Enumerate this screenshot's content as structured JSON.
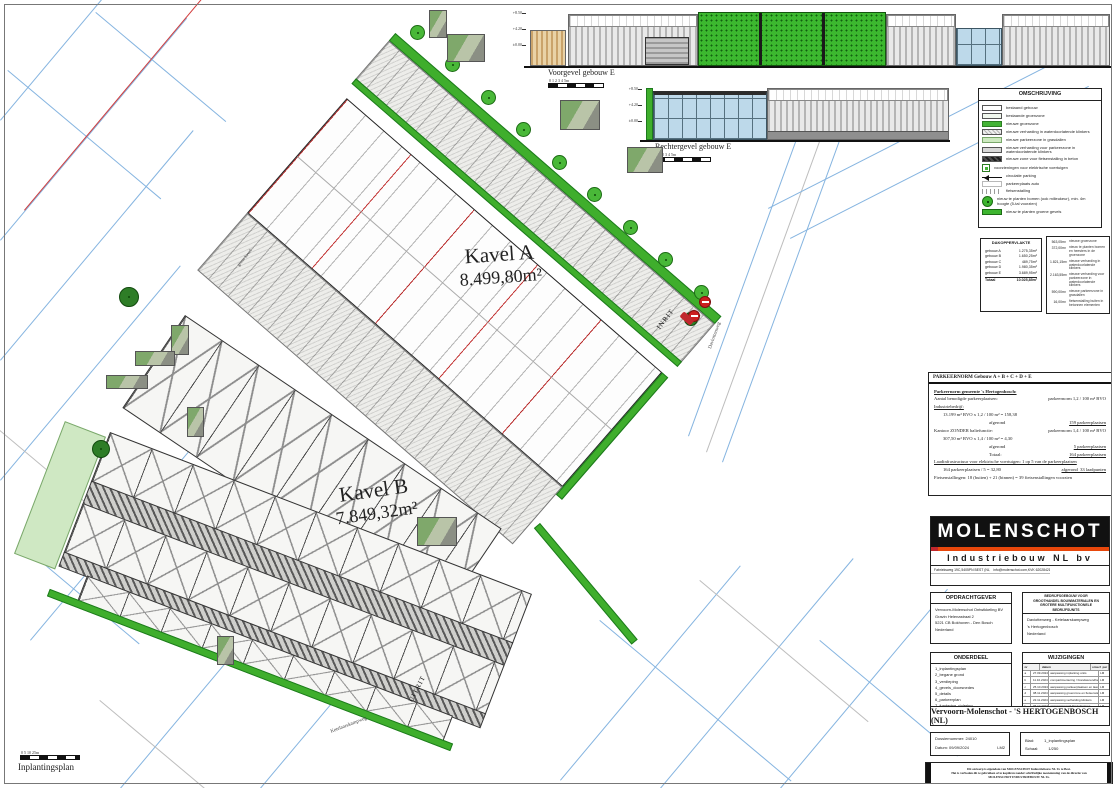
{
  "sheet": {
    "caption": "Inplantingsplan",
    "scale_label": "0 5 10 25m"
  },
  "plan": {
    "kavel_a_name": "Kavel A",
    "kavel_a_area": "8.499,80m²",
    "kavel_b_name": "Kavel B",
    "kavel_b_area": "7.849,32m²",
    "inrit": "INRIT",
    "uitrit": "UITRIT",
    "street_right": "Daviottenweg",
    "street_bottom": "Ketelaarskampweg",
    "boundary_label": "grens kavel"
  },
  "elevations": {
    "front_label": "Voorgevel gebouw E",
    "right_label": "Rechtergevel gebouw E",
    "scale_label": "0 1 2 3 4 5m",
    "levels": [
      "+8.50",
      "+4.20",
      "±0.00"
    ]
  },
  "legend": {
    "title": "OMSCHRIJVING",
    "items": [
      {
        "label": "bestaand gebouw",
        "swatch": "existing-building"
      },
      {
        "label": "bestaande groenzone",
        "swatch": "existing-green"
      },
      {
        "label": "nieuwe groenzone",
        "swatch": "new-green"
      },
      {
        "label": "nieuwe verharding in waterdoorlatende klinkers",
        "swatch": "pavers"
      },
      {
        "label": "nieuwe parkeerzone in grasdallen",
        "swatch": "grass-pavers"
      },
      {
        "label": "nieuwe verharding voor parkeerzone in waterdoorlatende klinkers",
        "swatch": "pavers-parking"
      },
      {
        "label": "nieuwe zone voor fietsenstalling in beton",
        "swatch": "bike-concrete"
      },
      {
        "label": "voorzieningen voor elektrische voertuigen",
        "swatch": "ev-charger"
      },
      {
        "label": "circulatie parking",
        "swatch": "arrow"
      },
      {
        "label": "parkeerplaats auto",
        "swatch": "parking-spot"
      },
      {
        "label": "fietsenstalling",
        "swatch": "bike-rack"
      },
      {
        "label": "nieuw te planten bomen (ook milieukeur), min. 4m hoogte (5-tal voorzien)",
        "swatch": "tree-sym"
      },
      {
        "label": "nieuw te planten groene gevels",
        "swatch": "green-facade"
      }
    ]
  },
  "area_table": {
    "title": "DAKOPPERVLAKTE",
    "rows": [
      [
        "gebouw A",
        "1.275,35m²"
      ],
      [
        "gebouw B",
        "1.650,25m²"
      ],
      [
        "gebouw C",
        "489,75m²"
      ],
      [
        "gebouw D",
        "1.980,35m²"
      ],
      [
        "gebouw E",
        "3.689,95m²"
      ]
    ],
    "total_label": "Totaal",
    "total_value": "10.025,85m²"
  },
  "surface_table": {
    "rows": [
      [
        "563,05m²",
        "nieuwe groenzone"
      ],
      [
        "372,00m²",
        "nieuw te planten bomen en heesters in de groenzone"
      ],
      [
        "1.821,15m²",
        "nieuwe verharding in waterdoorlatende klinkers"
      ],
      [
        "2.163,55m²",
        "nieuwe verharding voor parkeerzone in waterdoorlatende klinkers"
      ],
      [
        "590,00m²",
        "nieuwe parkeerzone in grasdallen"
      ],
      [
        "16,00m²",
        "fietsenstalling buiten in betonnen elementen"
      ]
    ]
  },
  "parking": {
    "title": "PARKEERNORM Gebouw A + B + C + D + E",
    "lines": [
      {
        "l": "Parkeernorm gemeente 's Hertogenbosch:",
        "cls": "u b"
      },
      {
        "l": "Aantal benodigde parkeerplaatsen:",
        "r": "parkeernorm 1,2 / 100 m² BVO"
      },
      {
        "l": "Industriebedrijf:",
        "cls": "u"
      },
      {
        "l": "13.199 m² BVO x 1,2 / 100 m² = 158,38",
        "cls": "ind"
      },
      {
        "l": "afgerond",
        "r": "159 parkeerplaatsen",
        "cls": "ind2 ru"
      },
      {
        "l": "Kantoor ZONDER baliefunctie:",
        "r": "parkeernorm 1,4 / 100 m² BVO"
      },
      {
        "l": "307,50 m² BVO x 1,4 / 100 m² = 4,30",
        "cls": "ind"
      },
      {
        "l": "afgerond",
        "r": "5 parkeerplaatsen",
        "cls": "ind2 ru"
      },
      {
        "l": "Totaal:",
        "r": "164 parkeerplaatsen",
        "cls": "ind2 ru"
      },
      {
        "l": "Laadinfrastructuur voor elektrische voertuigen: 1 op 5 van de parkeerplaatsen",
        "cls": "u"
      },
      {
        "l": "164 parkeerplaatsen / 5 = 32,80",
        "r": "afgerond  33 laadpunten",
        "cls": "ind ru"
      },
      {
        "l": "Fietsenstallingen: 18 (buiten) + 21 (binnen) = 39 fietsenstallingen voorzien"
      }
    ]
  },
  "titleblock": {
    "brand": "MOLENSCHOT",
    "brand_sub": "Industriebouw NL bv",
    "contact_rows": [
      [
        "Fabrieksweg 19C",
        "5405PN BEST (NL)",
        "T +31 (0)6 14 59 28 28"
      ],
      [
        "info@molenschot.com",
        "KVK 62028421",
        "BTW NL 8632.87.566.B01"
      ]
    ],
    "opdrachtgever_title": "OPDRACHTGEVER",
    "opdrachtgever_lines": [
      "Vervoorn-Molenschot Ontwikkeling BV",
      "Gravin Helenastraat 2",
      "5221 CB Bokhoven - Den Bosch",
      "Nederland"
    ],
    "project_title_lines": [
      "BEDRIJFSGEBOUW VOOR",
      "GROOTHANDEL BOUWMATERIALEN EN",
      "GROTERE MULTIFUNCTIONELE",
      "BEDRIJFSUNITS"
    ],
    "project_address": [
      "Daviottenweg - Ketelaarskampweg",
      "'s Hertogenbosch",
      "Nederland"
    ],
    "onderdeel_title": "ONDERDEEL",
    "onderdeel_items": [
      "1_inplantingsplan",
      "2_begane grond",
      "3_verdieping",
      "4_gevels_doorsnedes",
      "5_details",
      "6_parkeerplan",
      "7_fundering_riolering",
      "8_bouwplaatsinrichting"
    ],
    "wijzigingen_title": "WIJZIGINGEN",
    "wijzigingen_headers": [
      "nr",
      "datum",
      "omschrijving wijziging",
      "par"
    ],
    "wijzigingen_rows": [
      [
        "a",
        "27.09.2024",
        "aanpassing inplanting units",
        "LM"
      ],
      [
        "b",
        "11.10.2024",
        "compartimentering / brandwerendheid gebouwen",
        "LM"
      ],
      [
        "c",
        "25.10.2024",
        "aanpassing parkeerplaatsen en laadpunten",
        "LM"
      ],
      [
        "d",
        "08.11.2024",
        "aanpassing groenzone en fietsenstalling",
        "LM"
      ],
      [
        "e",
        "22.11.2024",
        "aanpassing verharding klinkers",
        "LM"
      ],
      [
        "f",
        "06.12.2024",
        "aanpassing inrit Daviottenweg",
        "LM"
      ]
    ],
    "project_name": "Vervoorn-Molenschot - 'S HERTOGENBOSCH (NL)",
    "dossier": "Dossiernummer: 24010",
    "datum": "Datum: 09/09/2024",
    "initials": "LM2",
    "blad_label": "Blad:",
    "blad_value": "1_inplantingsplan",
    "schaal_label": "Schaal:",
    "schaal_value": "1/250",
    "copyright_lines": [
      "Dit ontwerp is eigendom van MOLENSCHOT Industriebouw NL bv te Best.",
      "Het is verboden dit te gebruiken of te kopiëren zonder schriftelijke toestemming van de directie van",
      "MOLENSCHOT INDUSTRIEBOUW NL bv."
    ],
    "colors": {
      "brand_black": "#111111",
      "brand_orange": "#e8470b",
      "accent_red": "#c1272d",
      "green": "#3fae2c"
    }
  }
}
